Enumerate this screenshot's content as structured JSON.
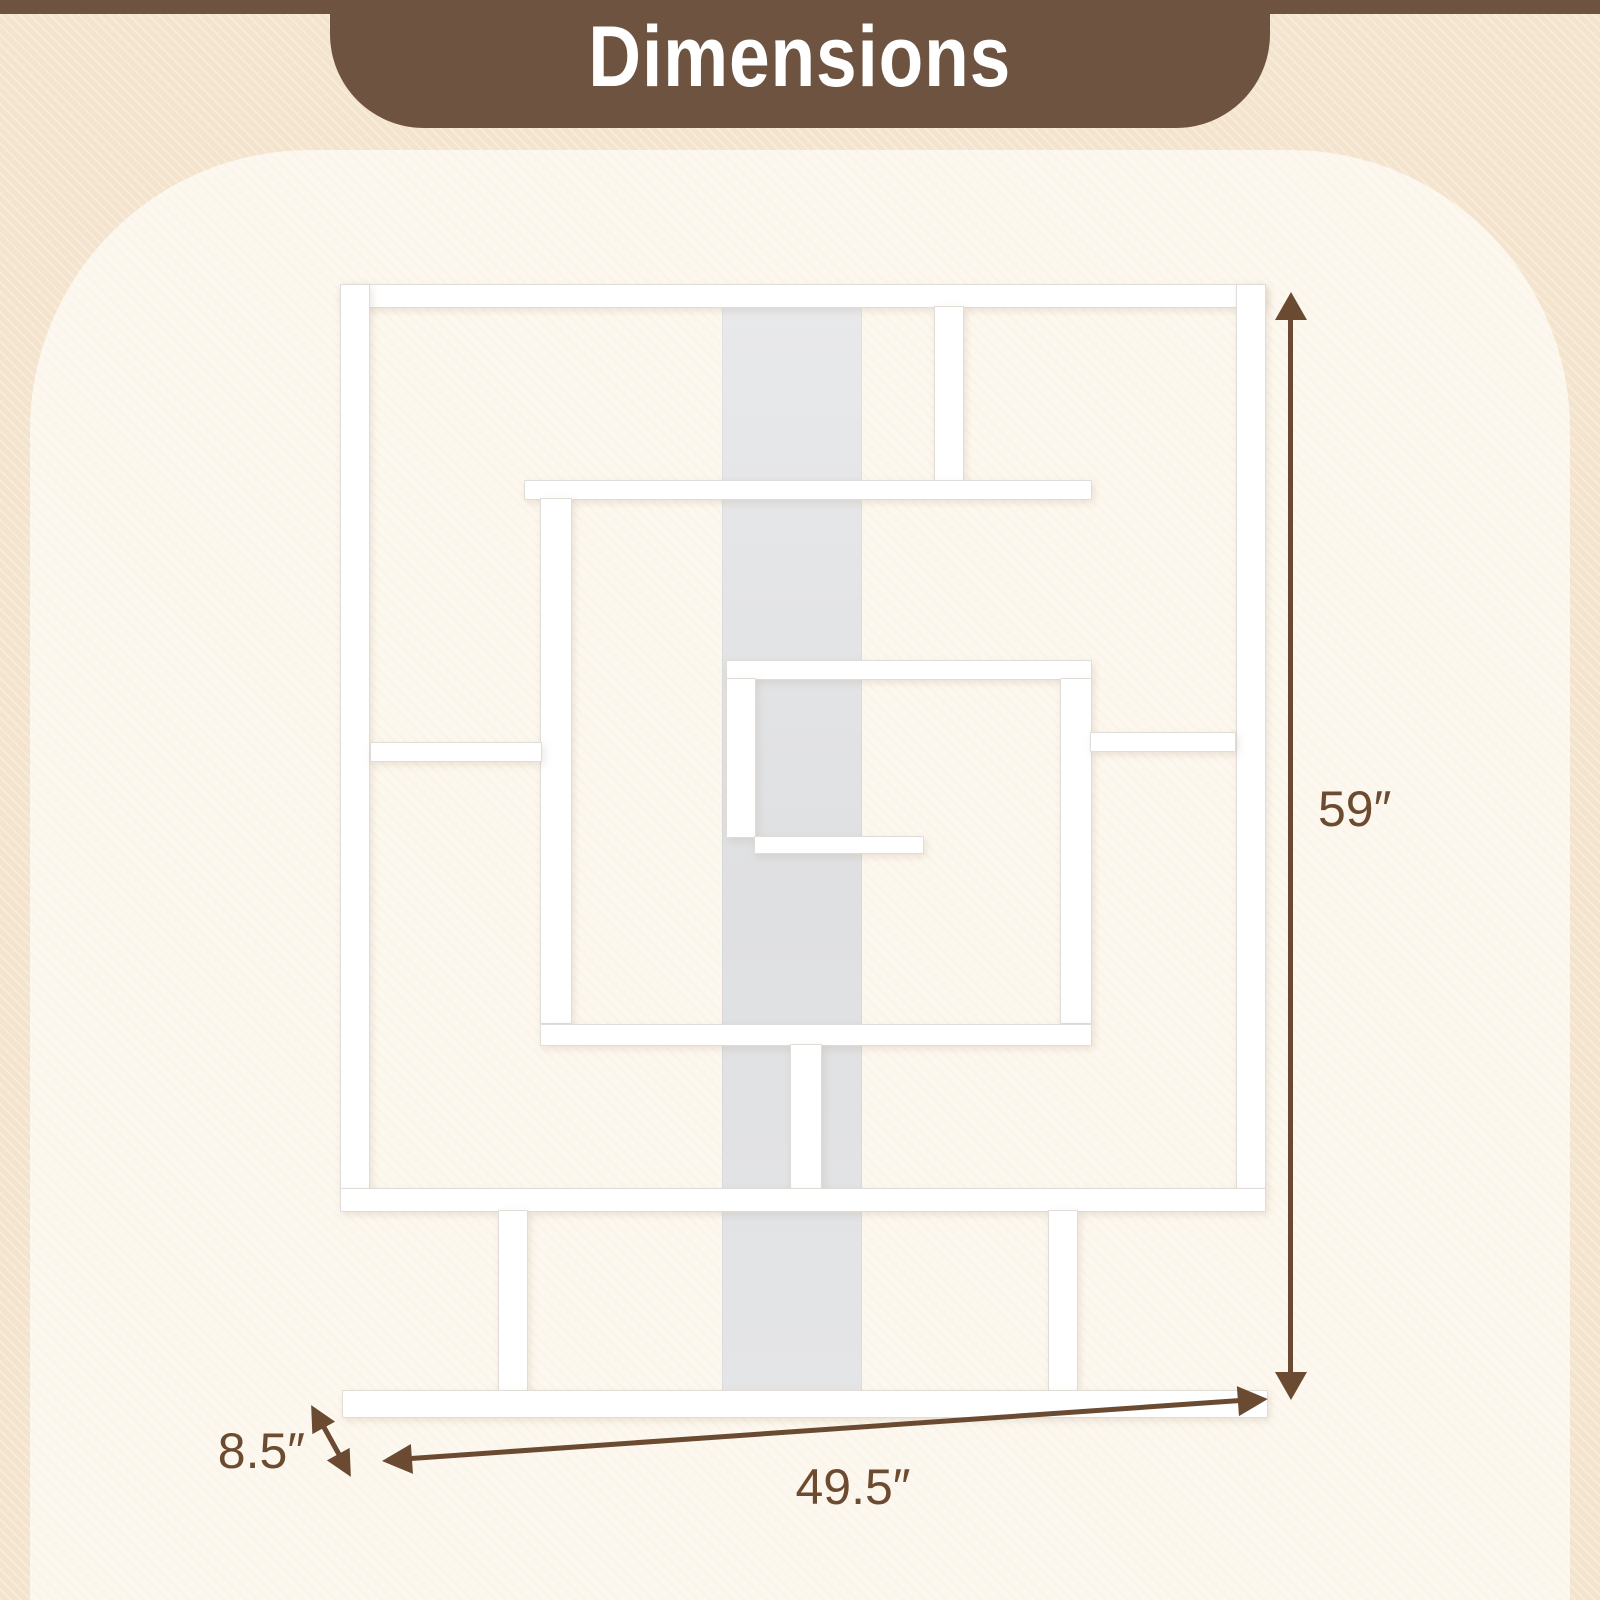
{
  "header": {
    "title": "Dimensions",
    "bg_color": "#6e5340",
    "text_color": "#ffffff"
  },
  "product": {
    "name": "geometric maze bookshelf",
    "panel_color": "#ffffff",
    "back_panel_color": "#e2e3e5"
  },
  "dimensions": {
    "height": {
      "label": "59″",
      "orientation": "vertical"
    },
    "width": {
      "label": "49.5″",
      "orientation": "horizontal"
    },
    "depth": {
      "label": "8.5″",
      "orientation": "diagonal"
    }
  },
  "colors": {
    "background": "#f4e4cd",
    "card": "#fdf8ef",
    "annotation": "#6a4a31"
  }
}
